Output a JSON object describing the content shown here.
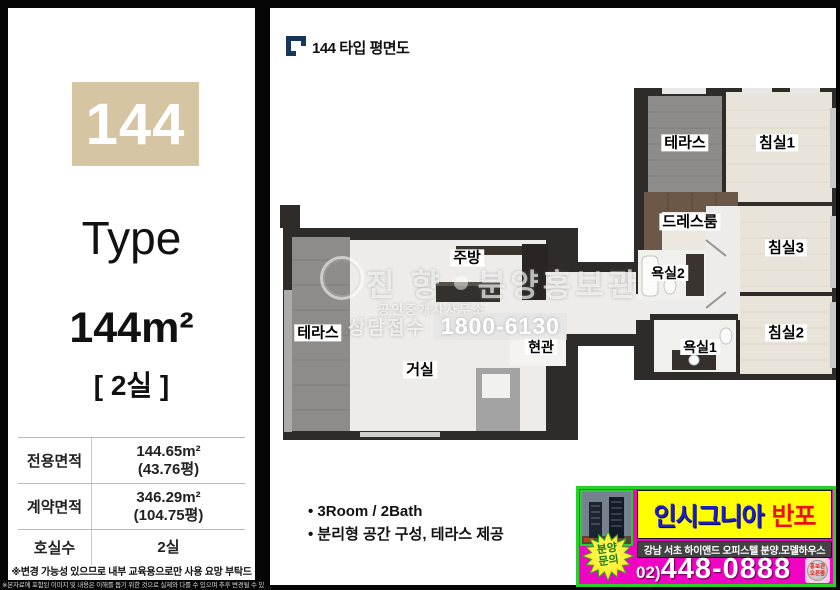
{
  "sidebar": {
    "unit_number": "144",
    "type_label": "Type",
    "area_text": "144m²",
    "rooms_text": "[ 2실 ]",
    "table": {
      "rows": [
        {
          "label": "전용면적",
          "line1": "144.65m²",
          "line2": "(43.76평)"
        },
        {
          "label": "계약면적",
          "line1": "346.29m²",
          "line2": "(104.75평)"
        },
        {
          "label": "호실수",
          "line1": "2실",
          "line2": ""
        }
      ]
    },
    "note": "※변경 가능성 있으므로 내부 교육용으로만 사용 요망 부탁드립니다.",
    "footer_disclaimer": "※본자료에 포함된 이미지 및 내용은 이해를 돕기 위한 것으로 실제와 다를 수 있으며 추후 변경될 수 있습니다"
  },
  "header": {
    "title": "144 타입 평면도"
  },
  "plan": {
    "rooms": {
      "terrace_top": "테라스",
      "bedroom1": "침실1",
      "dressroom": "드레스룸",
      "bedroom3": "침실3",
      "bath2": "욕실2",
      "kitchen": "주방",
      "terrace_left": "테라스",
      "bedroom2": "침실2",
      "bath1": "욕실1",
      "entrance": "현관",
      "living": "거실"
    }
  },
  "watermark": {
    "brand": "진 향",
    "brand_suffix": "분양홍보관",
    "subtitle": "공인중개사사무소",
    "call_label": "상담접수",
    "call_number": "1800-6130"
  },
  "features": {
    "items": [
      "• 3Room / 2Bath",
      "• 분리형 공간 구성, 테라스 제공"
    ]
  },
  "ad": {
    "brand_primary": "인시그니아",
    "brand_secondary": "반포",
    "subtitle": "강남 서초 하이앤드 오피스텔 분양.모델하우스",
    "phone_prefix": "02)",
    "phone_number": "448-0888",
    "badge_line1": "분양",
    "badge_line2": "문의",
    "sticker_line1": "홍보관",
    "sticker_line2": "오픈중"
  },
  "colors": {
    "accent_tan": "#d6c5a2",
    "navy": "#17365c",
    "wall": "#2e2b29",
    "ad_green": "#2bcf2b",
    "ad_yellow": "#ffff00",
    "ad_magenta": "#f103c3"
  }
}
